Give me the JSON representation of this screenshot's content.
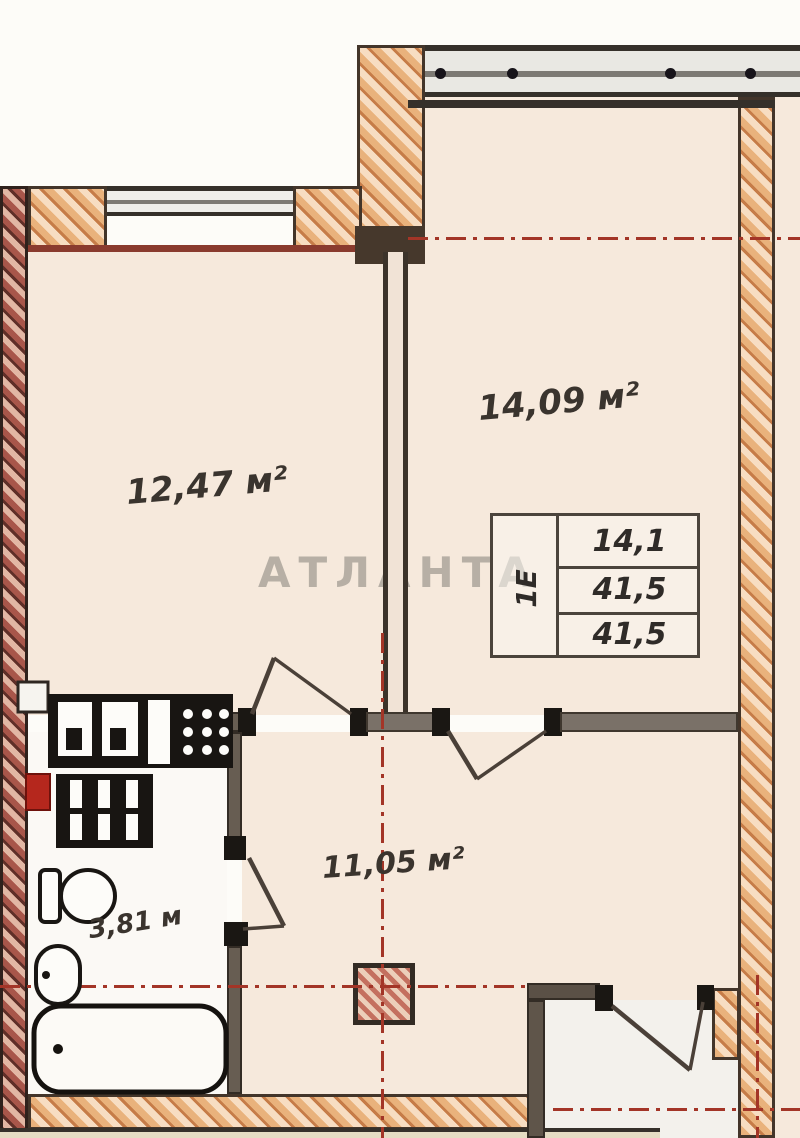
{
  "plan": {
    "watermark": "АТЛАНТА",
    "rooms": [
      {
        "id": "bedroom",
        "label": "14,09 м²"
      },
      {
        "id": "kitchen-living",
        "label": "12,47 м²"
      },
      {
        "id": "hallway",
        "label": "11,05 м²"
      },
      {
        "id": "bathroom",
        "label": "3,81 м"
      }
    ],
    "stamp": {
      "type_label": "1Е",
      "rows": [
        "14,1",
        "41,5",
        "41,5"
      ]
    },
    "colors": {
      "room_fill": "#f6e9dc",
      "wall_hatch": "#e9b27c",
      "outer_wall_hatch": "#a8564a",
      "axis_red": "#a33527",
      "wall_outline": "#3f372e",
      "fixture_ink": "#181512",
      "watermark_gray": "#7d7a73"
    }
  }
}
